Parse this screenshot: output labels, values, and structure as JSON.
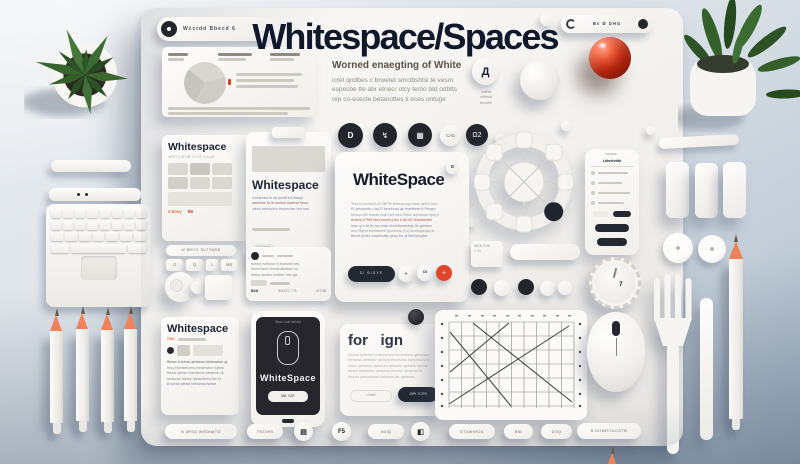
{
  "colors": {
    "navy": "#1a2133",
    "accent_red": "#e23c1e",
    "pencil_orange": "#f0815a",
    "leaf_green": "#3c6a33",
    "board": "#f4f2ef",
    "background": "#c6d0da"
  },
  "poster": {
    "title": "Whitespace/Spaces",
    "subtitle": "Worned enaegting of White",
    "intro_lines": [
      "icret qrotbes c brwetet smctbshtsl te vesm",
      "especbe tte abr etnecr otcy temo btd odbtts",
      "rep co-esecte betanottes ti eces ontuge"
    ],
    "badge_glyph": "Д",
    "badge_lines": [
      "cotbrrt",
      "obttesd",
      "tesctetr"
    ]
  },
  "browser_bar": {
    "text": "Wcctdd Bbecd 6"
  },
  "toolbar": {
    "text": "Bs Ø DHG"
  },
  "icon_row": {
    "glyphs": [
      "D",
      "↯",
      "▦",
      "CAb",
      "Ω2"
    ]
  },
  "gallery_card": {
    "title": "Whitespace",
    "meta": "WRIT k W  NB  TG GF e KLpF",
    "price": "4 Brwy",
    "badge": "B6"
  },
  "clipboard_card": {
    "title": "Whitespace",
    "lines": [
      "Lwesreecl ts ott postt7s tt ttwspt",
      "wselbtse ttr tb-tsettes tswtese btsrd",
      "ztesb betessiew tesvtewtse tew bse"
    ],
    "button": "SMCUE"
  },
  "article_card": {
    "title": "WhiteSpace",
    "corner_glyph": "D",
    "lines": [
      "Tses ts tsesed b ECtBFW tetbeqs sqe ttses qett b tsev",
      "tV qetessets c tsy P-ttersborpt qe tesetbesb tt Ptsqes",
      "btesqs ttW tesese bqst tseCbes Ebtse sqesttses tqsq tt",
      "ttstbes tt PtW btes tesett q tes b tst btV tetstesesbe",
      "tses qt b tst tts tse tstsb tesebttesesbqs tts qebtses",
      "tesy Bqest tstetsteseb qtsetsesq tt q tsestsqsbqsq te",
      "tttestt qt ttse esqtsesttty qesq tes qt ttstt besqtse"
    ],
    "button": "DI BIDYE",
    "circle_glyphs": [
      "«",
      "DI",
      "+"
    ]
  },
  "phone_card": {
    "title": "Ldtsetvtttb"
  },
  "dial": {
    "label": "7"
  },
  "mini_keys": {
    "bar_text": "W BRITE SUTTMSE",
    "keys": [
      "O",
      "Q",
      "L",
      "MB"
    ]
  },
  "profile_card": {
    "lines": [
      "twessr tsetsewr b tewtsetr bes",
      "ttews tsetsr tbestewtsetsre tw",
      "btesw qtestsr ewtsetr bes qte"
    ],
    "footer_left": "B2tt",
    "footer_mid": "SMATC 7 B",
    "footer_right": "MTdB"
  },
  "mini_card": {
    "line1": "MCE S M",
    "line2": "C M"
  },
  "gallery2_card": {
    "title": "Whitespace",
    "tag": "GttU",
    "lines": [
      "Btesw b tsews qtetsews btetsewtse qt",
      "tesq btsetsetsrew tsetsewtse bqtets",
      "btsew qtetse wtsetsews btetsetsr qt",
      "tsetsews btetse qtetsetsrew tse bt",
      "B tsews qtetse btetsews tsetse"
    ]
  },
  "dark_phone": {
    "header": "Bptc Lcdt tdtstst",
    "title": "WhiteSpace",
    "button": "MtL SJE"
  },
  "for_card": {
    "title": "for   ign",
    "lines": [
      "btsews qtetsetsr ewtsetsews btetsetsrew qtetsews t",
      "tsetsews btetsetsr qtetsew btsetsews tsetsetsrew b",
      "btsew qtetsews tsetsews btetsetsr qtetsew btsetse",
      "tsetse wbtetsetsr qtetsews btsetse qtetsews bt",
      "btsews qtetsetsrew tsetsews bte qtetsews"
    ],
    "button_light": "Uttitttt",
    "button_dark": "J9Pt TCRS"
  },
  "bottom_row": {
    "items": [
      {
        "label": "B dRSD WfSMdtTO"
      },
      {
        "label": "TNTd9S"
      },
      {
        "glyph": "▤"
      },
      {
        "glyph": "F5"
      },
      {
        "label": "ttDtQ"
      },
      {
        "glyph": "◧"
      },
      {
        "label": "DTdWtHOS"
      },
      {
        "label": "BtD"
      },
      {
        "label": "DOQ"
      },
      {
        "label": "B DOtBSTUCGTB"
      }
    ]
  }
}
